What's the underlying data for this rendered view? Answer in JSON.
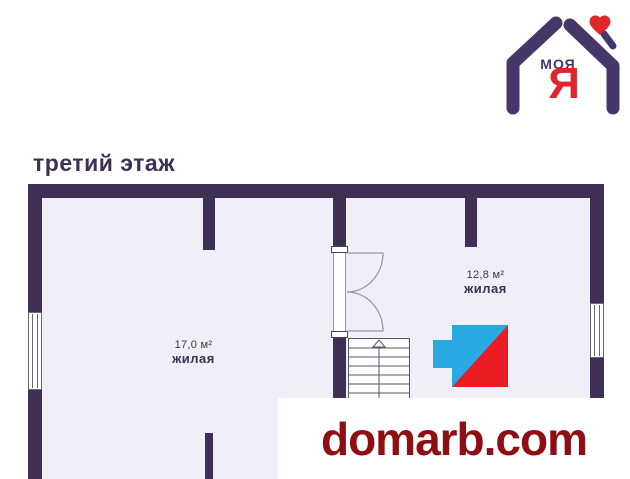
{
  "header": {
    "floor_title": "третий этаж"
  },
  "brand": {
    "name_text": "МОЯ",
    "letter": "Я",
    "purple": "#463669",
    "red": "#e0252b",
    "heart_color": "#e0252b"
  },
  "plan": {
    "wall_color": "#3f2f55",
    "floor_color": "#f0eef6",
    "rooms": [
      {
        "area": "17,0 м²",
        "label": "жилая"
      },
      {
        "area": "12,8 м²",
        "label": "жилая"
      }
    ],
    "agency_mark_colors": {
      "blue": "#29a9e1",
      "red": "#ec1c24"
    }
  },
  "watermark": {
    "site": "domarb.com",
    "color": "#8d0f13"
  }
}
